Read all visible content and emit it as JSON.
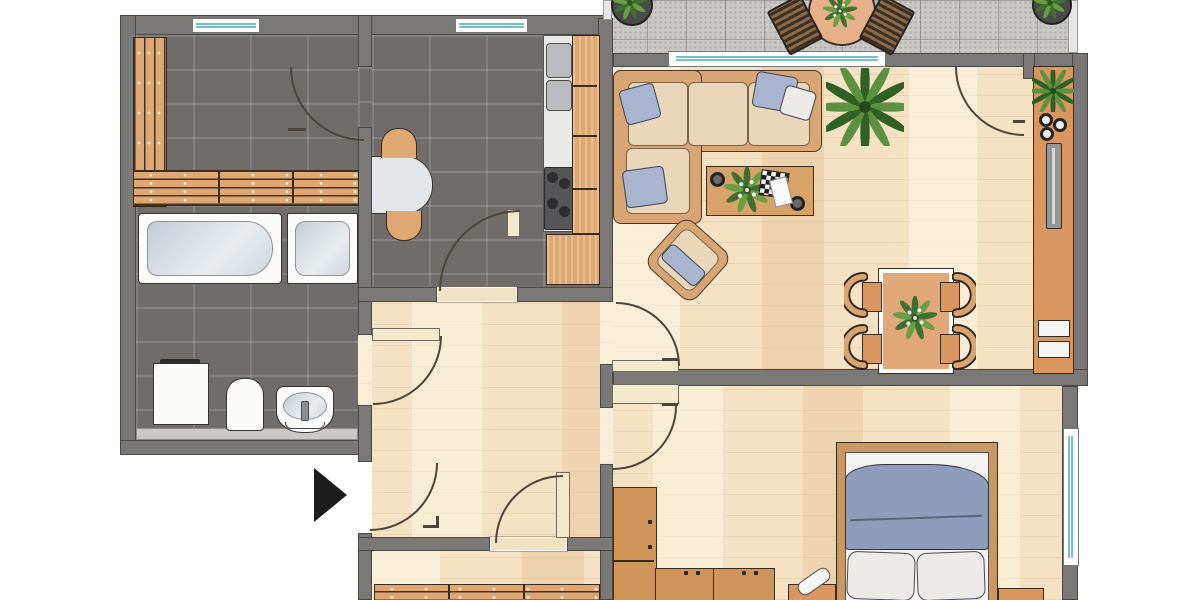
{
  "plan_title": "2-room apartment floor plan",
  "visible_text": [],
  "colors": {
    "wall": "#7b7977",
    "wall-line": "#4b4945",
    "tile": "#6f6c6a",
    "grout": "rgba(255,255,255,0.14)",
    "parquet": "#f5e2c3",
    "balcony": "#c9c8c5",
    "wood": "#dfa873",
    "wood-line": "#3a2c1c",
    "white-fix": "#fbfbfa",
    "glass": "#76c0c8",
    "sofa": "#ead7ba",
    "pillow": "#a9b5cf",
    "blanket": "#8d9cba",
    "tan-furn": "#d9965e",
    "arc": "#4e453a"
  },
  "rooms": [
    {
      "id": "bathroom",
      "label": "Bathroom",
      "floor": "dark-gray-tile",
      "furniture": [
        "wooden-bench-slats-L",
        "bathtub",
        "shower",
        "washing-machine",
        "toilet",
        "wash-basin"
      ]
    },
    {
      "id": "kitchen",
      "label": "Kitchen",
      "floor": "dark-gray-tile",
      "furniture": [
        "half-round-table",
        "two-stools",
        "sink-unit",
        "stove-4-burners",
        "cabinet-column",
        "base-cabinet"
      ]
    },
    {
      "id": "living-room",
      "label": "Living room",
      "floor": "parquet",
      "furniture": [
        "corner-sofa",
        "cushions",
        "coffee-table",
        "game-board",
        "houseplant-large",
        "armchair",
        "dining-table",
        "four-chairs",
        "sideboard",
        "tv",
        "bowls",
        "plants"
      ]
    },
    {
      "id": "bedroom",
      "label": "Bedroom",
      "floor": "parquet",
      "furniture": [
        "double-bed",
        "pillows",
        "blanket",
        "wardrobe-L",
        "nightstand-left",
        "nightstand-right"
      ]
    },
    {
      "id": "hallway",
      "label": "Hallway",
      "floor": "parquet",
      "furniture": []
    },
    {
      "id": "bottom-room",
      "label": "Room (partially cut off)",
      "floor": "parquet",
      "furniture": [
        "radiator-slats"
      ]
    },
    {
      "id": "balcony",
      "label": "Balcony",
      "floor": "stone-tile",
      "furniture": [
        "bistro-table",
        "two-folding-chairs",
        "potted-plant-left",
        "potted-plant-right"
      ]
    }
  ],
  "windows": [
    {
      "room": "bathroom",
      "wall": "top"
    },
    {
      "room": "kitchen",
      "wall": "top"
    },
    {
      "room": "living-room",
      "wall": "top",
      "size": "large"
    },
    {
      "room": "bedroom",
      "wall": "right"
    }
  ],
  "doors": [
    {
      "from": "kitchen",
      "to": "bathroom"
    },
    {
      "from": "hallway",
      "to": "bathroom"
    },
    {
      "from": "hallway",
      "to": "kitchen"
    },
    {
      "from": "outside",
      "to": "hallway",
      "type": "entrance",
      "marker": "black-triangle-arrow"
    },
    {
      "from": "hallway",
      "to": "bottom-room"
    },
    {
      "from": "hallway",
      "to": "living-room"
    },
    {
      "from": "hallway",
      "to": "bedroom"
    },
    {
      "from": "living-room",
      "to": "balcony"
    }
  ]
}
